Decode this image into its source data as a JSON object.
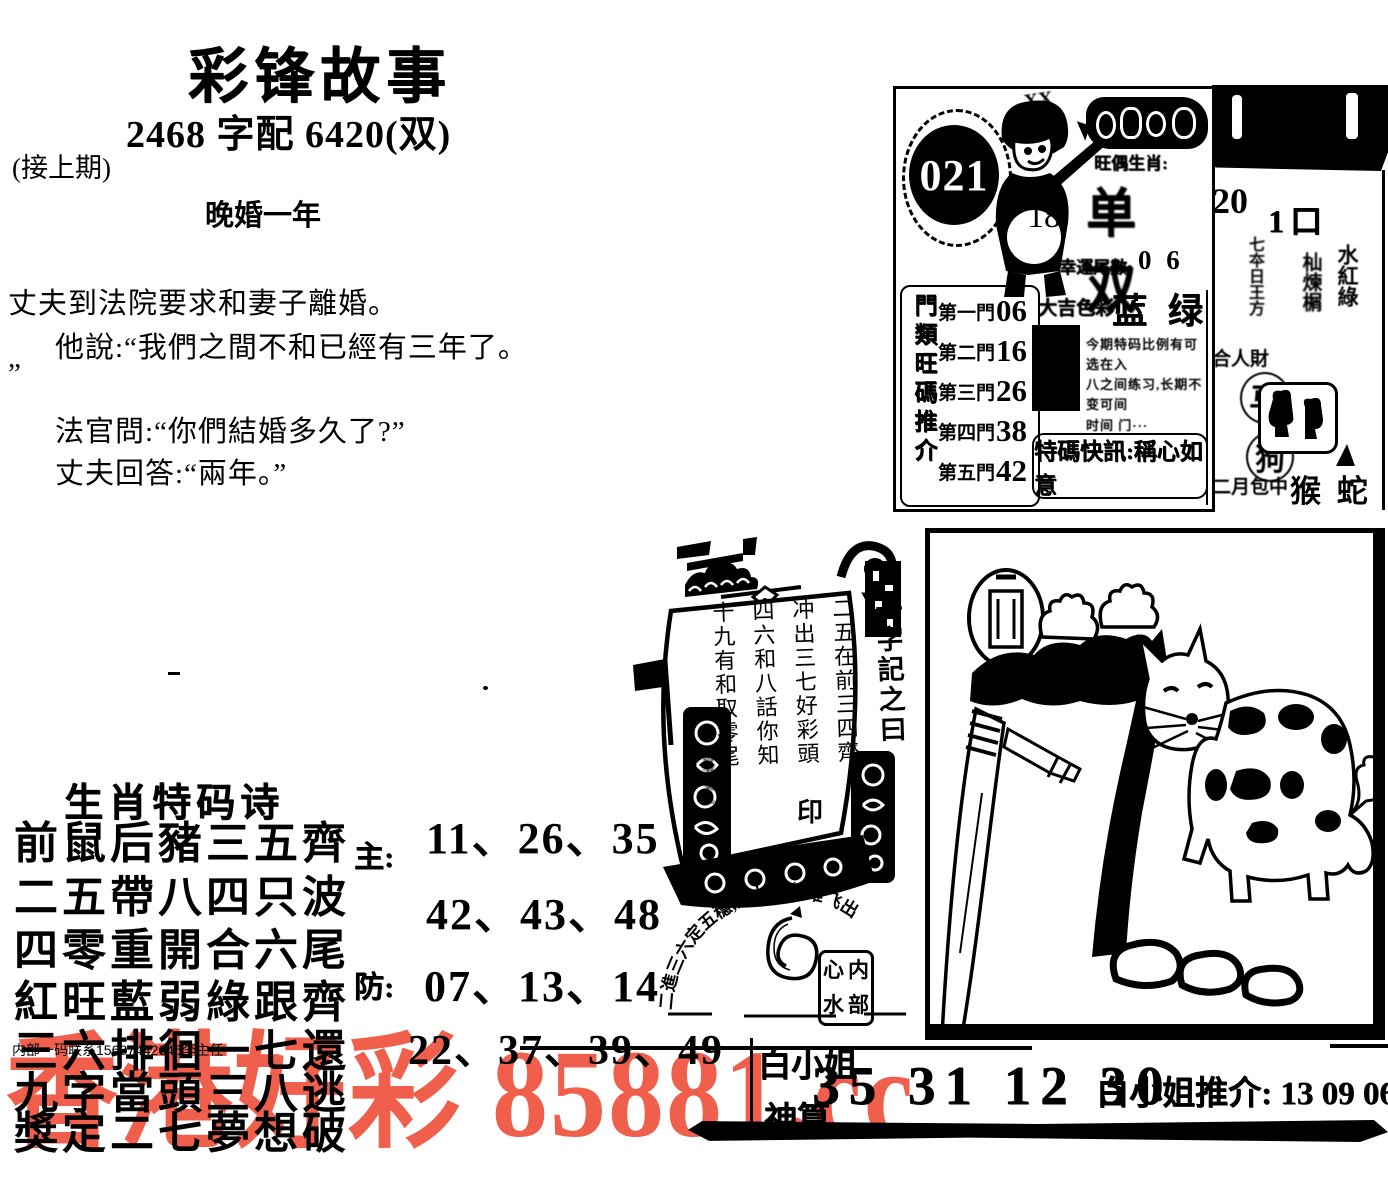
{
  "header": {
    "title": "彩锋故事",
    "subtitle": "2468 字配 6420(双)",
    "continued": "(接上期)",
    "story_title": "晚婚一年"
  },
  "story": {
    "line1": "丈夫到法院要求和妻子離婚。",
    "line2": "他說:“我們之間不和已經有三年了。",
    "line3": "”",
    "line4": "法官問:“你們結婚多久了?”",
    "line5": "丈夫回答:“兩年。”"
  },
  "promo": {
    "issue_badge": "021",
    "boy_number": "18",
    "scribble": "XX",
    "odd_even_label": "旺偶生肖:",
    "odd_even_value": "单双",
    "lucky_tail_label": "幸運尾數:",
    "lucky_tail_value": "0 6",
    "doors_title": "門類旺碼推介",
    "doors": [
      {
        "label": "第一門",
        "value": "06"
      },
      {
        "label": "第二門",
        "value": "16"
      },
      {
        "label": "第三門",
        "value": "26"
      },
      {
        "label": "第四門",
        "value": "38"
      },
      {
        "label": "第五門",
        "value": "42"
      }
    ],
    "color_label": "大吉色彩:",
    "color_value": "蓝 绿",
    "note_line1": "今期特码比例有可选在入",
    "note_line2": "八之间练习,长期不变可间",
    "note_line3": "时间 门···",
    "slogan": "特碼快訊:稱心如意"
  },
  "sidebar": {
    "number": "20",
    "date": "1口",
    "col_a": "七夲日王方",
    "col_b": "杣煉榍",
    "col_c": "水紅綠",
    "fortune": "合人財",
    "zodiac_circle_1": "马",
    "zodiac_circle_2": "狗",
    "month_label": "二月包中",
    "month_zodiac": "猴 蛇"
  },
  "ship": {
    "sail_line1": "一字記之曰:",
    "sail_line2": "二五在前三四齊",
    "sail_line3": "冲出三七好彩頭",
    "sail_line4": "四六和八話你知",
    "sail_line5": "十九有和取零尾",
    "seal": "印",
    "side_note": "香港女儿"
  },
  "stamp": {
    "arc_text": "二進三六定五穩,四九小數难飞出"
  },
  "seal_box": {
    "chars": [
      "心",
      "内",
      "水",
      "部"
    ]
  },
  "poem": {
    "heading": "生肖特码诗",
    "lines": [
      "前鼠后豬三五齊",
      "二五帶八四只波",
      "四零重開合六尾",
      "紅旺藍弱綠跟齊",
      "三六排徊一七還",
      "九字當頭三八逃",
      "獎定二七夢想破"
    ]
  },
  "numbers": {
    "main_label": "主:",
    "main_row1": "11、26、35",
    "main_row2": "42、43、48",
    "guard_label": "防:",
    "guard_row1": "07、13、14",
    "guard_row2": "22、37、39、49"
  },
  "contact": "内部一码联系15687442645李主任",
  "bottom": {
    "tipster": "白小姐",
    "tipster2": "神算",
    "numbers": "35 31 12 30",
    "recommend": "白小姐推介: 13 09 06 41 17"
  },
  "watermark": {
    "text": "香港好彩 85881.cc",
    "color": "#ef5f4c"
  }
}
